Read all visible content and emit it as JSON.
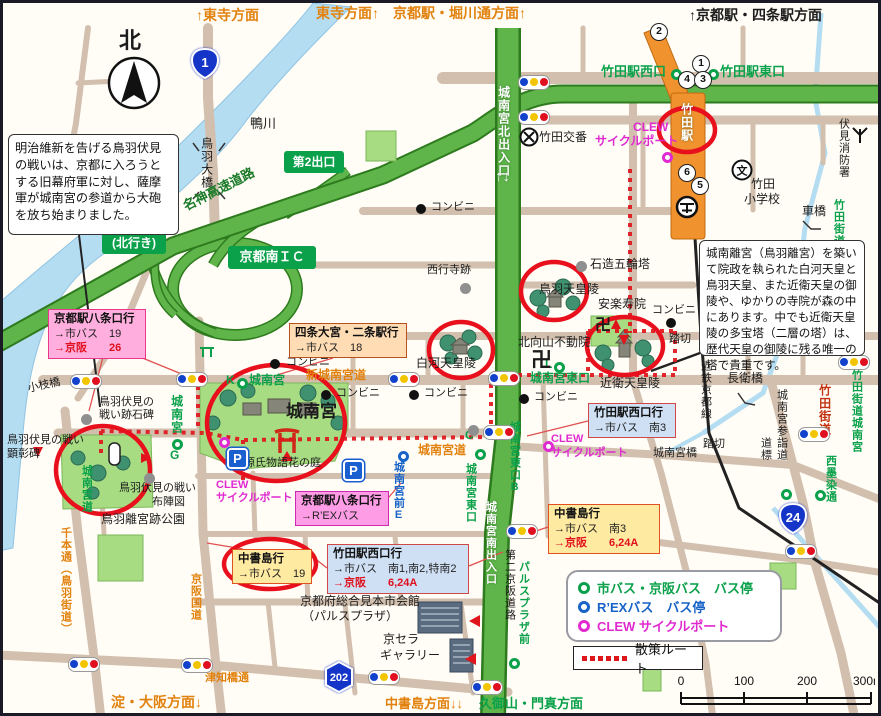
{
  "title": "城南宮・竹田駅周辺 散策マップ",
  "edge_labels": [
    {
      "t": "↑東寺方面",
      "x": 193,
      "y": 5,
      "c": "orange",
      "s": 14
    },
    {
      "t": "東寺方面↑　京都駅・堀川通方面↑",
      "x": 313,
      "y": 3,
      "c": "orange",
      "s": 14
    },
    {
      "t": "↑京都駅・四条駅方面",
      "x": 686,
      "y": 5,
      "c": "dark",
      "s": 14,
      "b": 1
    },
    {
      "t": "淀・大阪方面↓",
      "x": 108,
      "y": 692,
      "c": "orange",
      "s": 14
    },
    {
      "t": "中書島方面↓↓",
      "x": 382,
      "y": 694,
      "c": "orange",
      "s": 13
    },
    {
      "t": "久御山・門真方面",
      "x": 476,
      "y": 694,
      "c": "green",
      "s": 13
    }
  ],
  "labels": [
    {
      "t": "北",
      "x": 116,
      "y": 26,
      "c": "dark",
      "s": 22,
      "b": 1
    },
    {
      "t": "鴨川",
      "x": 247,
      "y": 114,
      "c": "dark",
      "s": 13
    },
    {
      "t": "鳥羽大橋",
      "x": 197,
      "y": 134,
      "c": "dark",
      "s": 12,
      "v": 1
    },
    {
      "t": "名神高速道路",
      "x": 178,
      "y": 198,
      "c": "hwy",
      "s": 13,
      "r": -27
    },
    {
      "t": "小枝橋",
      "x": 24,
      "y": 381,
      "c": "dark",
      "s": 11,
      "r": -12
    },
    {
      "t": "竹田交番",
      "x": 536,
      "y": 128,
      "c": "dark",
      "s": 12
    },
    {
      "t": "竹田",
      "x": 748,
      "y": 175,
      "c": "dark",
      "s": 12
    },
    {
      "t": "小学校",
      "x": 741,
      "y": 190,
      "c": "dark",
      "s": 12
    },
    {
      "t": "伏見消防署",
      "x": 834,
      "y": 115,
      "c": "dark",
      "s": 11,
      "v": 1
    },
    {
      "t": "車橋",
      "x": 799,
      "y": 202,
      "c": "dark",
      "s": 12
    },
    {
      "t": "西行寺跡",
      "x": 424,
      "y": 262,
      "c": "dark",
      "s": 11
    },
    {
      "t": "石造五輪塔",
      "x": 587,
      "y": 255,
      "c": "dark",
      "s": 12
    },
    {
      "t": "鳥羽天皇陵",
      "x": 536,
      "y": 280,
      "c": "dark",
      "s": 12
    },
    {
      "t": "安楽寿院",
      "x": 595,
      "y": 295,
      "c": "dark",
      "s": 12
    },
    {
      "t": "北向山不動院",
      "x": 515,
      "y": 333,
      "c": "dark",
      "s": 12
    },
    {
      "t": "白河天皇陵",
      "x": 413,
      "y": 354,
      "c": "dark",
      "s": 12
    },
    {
      "t": "近衛天皇陵",
      "x": 597,
      "y": 374,
      "c": "dark",
      "s": 12
    },
    {
      "t": "踏切",
      "x": 666,
      "y": 331,
      "c": "dark",
      "s": 11
    },
    {
      "t": "踏切",
      "x": 700,
      "y": 436,
      "c": "dark",
      "s": 11
    },
    {
      "t": "長衛橋",
      "x": 724,
      "y": 369,
      "c": "dark",
      "s": 12
    },
    {
      "t": "近鉄京都線",
      "x": 696,
      "y": 357,
      "c": "dark",
      "s": 11,
      "v": 1
    },
    {
      "t": "城南宮参詣道",
      "x": 772,
      "y": 386,
      "c": "dark",
      "s": 11,
      "v": 1
    },
    {
      "t": "道標",
      "x": 756,
      "y": 434,
      "c": "dark",
      "s": 11,
      "v": 1
    },
    {
      "t": "城南宮橋",
      "x": 650,
      "y": 445,
      "c": "dark",
      "s": 11
    },
    {
      "t": "城南宮",
      "x": 283,
      "y": 400,
      "c": "dark",
      "s": 17,
      "b": 1
    },
    {
      "t": "源氏物語花の庭",
      "x": 241,
      "y": 455,
      "c": "dark",
      "s": 11
    },
    {
      "t": "鳥羽伏見の",
      "x": 96,
      "y": 394,
      "c": "dark",
      "s": 11
    },
    {
      "t": "戦い跡石碑",
      "x": 96,
      "y": 407,
      "c": "dark",
      "s": 11
    },
    {
      "t": "鳥羽伏見の戦い",
      "x": 4,
      "y": 432,
      "c": "dark",
      "s": 11
    },
    {
      "t": "顕彰碑",
      "x": 4,
      "y": 446,
      "c": "dark",
      "s": 11
    },
    {
      "t": "鳥羽伏見の戦い",
      "x": 116,
      "y": 480,
      "c": "dark",
      "s": 11
    },
    {
      "t": "布陣図",
      "x": 149,
      "y": 494,
      "c": "dark",
      "s": 11
    },
    {
      "t": "鳥羽離宮跡公園",
      "x": 98,
      "y": 510,
      "c": "dark",
      "s": 12
    },
    {
      "t": "京都府総合見本市会館",
      "x": 297,
      "y": 592,
      "c": "dark",
      "s": 12
    },
    {
      "t": "（パルスプラザ）",
      "x": 299,
      "y": 607,
      "c": "dark",
      "s": 12
    },
    {
      "t": "京セラ",
      "x": 380,
      "y": 630,
      "c": "dark",
      "s": 12
    },
    {
      "t": "ギャラリー",
      "x": 377,
      "y": 646,
      "c": "dark",
      "s": 12
    },
    {
      "t": "津知橋通",
      "x": 202,
      "y": 670,
      "c": "orange",
      "s": 11
    },
    {
      "t": "第二京阪道路",
      "x": 500,
      "y": 546,
      "c": "dark",
      "s": 11,
      "v": 1
    },
    {
      "t": "新城南宮道",
      "x": 303,
      "y": 366,
      "c": "orange",
      "s": 12
    },
    {
      "t": "城南宮道",
      "x": 415,
      "y": 441,
      "c": "orange",
      "s": 12
    },
    {
      "t": "千本通（鳥羽街道）",
      "x": 56,
      "y": 524,
      "c": "orange",
      "s": 11,
      "v": 1
    },
    {
      "t": "京阪国道",
      "x": 186,
      "y": 570,
      "c": "orange",
      "s": 11,
      "v": 1
    },
    {
      "t": "竹田駅西口",
      "x": 598,
      "y": 62,
      "c": "green",
      "s": 13
    },
    {
      "t": "竹田駅東口",
      "x": 717,
      "y": 62,
      "c": "green",
      "s": 13
    },
    {
      "t": "K",
      "x": 223,
      "y": 371,
      "c": "green",
      "s": 12
    },
    {
      "t": "城南宮",
      "x": 246,
      "y": 371,
      "c": "green",
      "s": 12
    },
    {
      "t": "城南宮",
      "x": 167,
      "y": 392,
      "c": "green",
      "s": 12,
      "v": 1
    },
    {
      "t": "G",
      "x": 167,
      "y": 446,
      "c": "green",
      "s": 12
    },
    {
      "t": "L",
      "x": 542,
      "y": 355,
      "c": "green",
      "s": 12
    },
    {
      "t": "城南宮東口",
      "x": 527,
      "y": 369,
      "c": "green",
      "s": 12
    },
    {
      "t": "城南宮東口B",
      "x": 505,
      "y": 418,
      "c": "green",
      "s": 11,
      "v": 1
    },
    {
      "t": "C",
      "x": 462,
      "y": 426,
      "c": "green",
      "s": 12
    },
    {
      "t": "城南宮東口",
      "x": 461,
      "y": 460,
      "c": "green",
      "s": 11,
      "v": 1
    },
    {
      "t": "城南宮道",
      "x": 77,
      "y": 462,
      "c": "green",
      "s": 11,
      "v": 1
    },
    {
      "t": "パルスプラザ前",
      "x": 514,
      "y": 558,
      "c": "green",
      "s": 11,
      "v": 1
    },
    {
      "t": "竹田街道",
      "x": 829,
      "y": 196,
      "c": "green",
      "s": 11,
      "v": 1
    },
    {
      "t": "竹田街道城南宮",
      "x": 847,
      "y": 366,
      "c": "green",
      "s": 11,
      "v": 1
    },
    {
      "t": "西墨染通",
      "x": 821,
      "y": 452,
      "c": "green",
      "s": 11,
      "v": 1
    },
    {
      "t": "城南宮前E",
      "x": 389,
      "y": 458,
      "c": "blue",
      "s": 11,
      "v": 1
    },
    {
      "t": "CLEW",
      "x": 630,
      "y": 118,
      "c": "mag",
      "s": 12
    },
    {
      "t": "サイクルポート",
      "x": 592,
      "y": 132,
      "c": "mag",
      "s": 12
    },
    {
      "t": "CLEW",
      "x": 213,
      "y": 477,
      "c": "mag",
      "s": 11
    },
    {
      "t": "サイクルポート",
      "x": 213,
      "y": 490,
      "c": "mag",
      "s": 11
    },
    {
      "t": "CLEW",
      "x": 548,
      "y": 431,
      "c": "mag",
      "s": 11
    },
    {
      "t": "サイクルポート",
      "x": 548,
      "y": 445,
      "c": "mag",
      "s": 11
    },
    {
      "t": "竹田街道",
      "x": 815,
      "y": 381,
      "c": "redst",
      "s": 12,
      "v": 1
    },
    {
      "t": "城南宮北出入口",
      "x": 494,
      "y": 83,
      "c": "white",
      "s": 12,
      "v": 1
    },
    {
      "t": "↑↓",
      "x": 492,
      "y": 166,
      "c": "white",
      "s": 15
    },
    {
      "t": "城南宮南出入口",
      "x": 481,
      "y": 498,
      "c": "white",
      "s": 11,
      "v": 1
    },
    {
      "t": "竹田駅",
      "x": 677,
      "y": 100,
      "c": "white",
      "s": 12,
      "v": 1
    },
    {
      "t": "コンビニ",
      "x": 283,
      "y": 354,
      "c": "dark",
      "s": 11
    },
    {
      "t": "コンビニ",
      "x": 333,
      "y": 385,
      "c": "dark",
      "s": 11
    },
    {
      "t": "コンビニ",
      "x": 421,
      "y": 385,
      "c": "dark",
      "s": 11
    },
    {
      "t": "コンビニ",
      "x": 531,
      "y": 389,
      "c": "dark",
      "s": 11
    },
    {
      "t": "コンビニ",
      "x": 649,
      "y": 302,
      "c": "dark",
      "s": 11
    },
    {
      "t": "コンビニ",
      "x": 428,
      "y": 199,
      "c": "dark",
      "s": 11
    },
    {
      "t": "卍",
      "x": 592,
      "y": 315,
      "c": "dark",
      "s": 16,
      "b": 1
    },
    {
      "t": "卍",
      "x": 528,
      "y": 347,
      "c": "dark",
      "s": 21,
      "b": 1
    }
  ],
  "green_boxes": [
    {
      "lines": [
        "第2出口"
      ],
      "x": 281,
      "y": 148,
      "w": 60,
      "h": 22,
      "s": 12
    },
    {
      "lines": [
        "第1出口",
        "(北行き)"
      ],
      "x": 99,
      "y": 214,
      "w": 64,
      "h": 37,
      "s": 12
    },
    {
      "lines": [
        "京都南ＩＣ"
      ],
      "x": 225,
      "y": 243,
      "w": 88,
      "h": 23,
      "s": 13
    }
  ],
  "info_boxes": [
    {
      "text": "明治維新を告げる鳥羽伏見の戦いは、京都に入ろうとする旧幕府軍に対し、薩摩軍が城南宮の参道から大砲を放ち始まりました。",
      "x": 5,
      "y": 131,
      "w": 171,
      "h": 101,
      "s": 12.2
    },
    {
      "text": "城南離宮（鳥羽離宮）を築いて院政を執られた白河天皇と鳥羽天皇、また近衛天皇の御陵や、ゆかりの寺院が森の中にあります。中でも近衛天皇陵の多宝塔（二層の塔）は、歴代天皇の御陵に残る唯一の塔で貴重です。",
      "x": 696,
      "y": 237,
      "w": 166,
      "h": 116,
      "s": 11.6
    }
  ],
  "bus_boxes": [
    {
      "title": "京都駅八条口行",
      "rows": [
        {
          "t": "→市バス　19",
          "red": false
        },
        {
          "t": "→京阪　　26",
          "red": true
        }
      ],
      "x": 45,
      "y": 306,
      "w": 98,
      "h": 48,
      "bg": "#ffaede",
      "bd": "#e8388c"
    },
    {
      "title": "四条大宮・二条駅行",
      "rows": [
        {
          "t": "→市バス　18",
          "red": false
        }
      ],
      "x": 286,
      "y": 320,
      "w": 118,
      "h": 35,
      "bg": "#ffdcb4",
      "bd": "#b85020"
    },
    {
      "title": "竹田駅西口行",
      "rows": [
        {
          "t": "→市バス　南3",
          "red": false
        }
      ],
      "x": 585,
      "y": 400,
      "w": 88,
      "h": 35,
      "bg": "#cfe0f5",
      "bd": "#d04848"
    },
    {
      "title": "中書島行",
      "rows": [
        {
          "t": "→市バス　南3",
          "red": false
        },
        {
          "t": "→京阪　　6,24A",
          "red": true
        }
      ],
      "x": 545,
      "y": 501,
      "w": 112,
      "h": 48,
      "bg": "#ffeaa2",
      "bd": "#e05020"
    },
    {
      "title": "中書島行",
      "rows": [
        {
          "t": "→市バス　19",
          "red": false
        }
      ],
      "x": 229,
      "y": 546,
      "w": 80,
      "h": 35,
      "bg": "#ffeaa2",
      "bd": "#e05020"
    },
    {
      "title": "竹田駅西口行",
      "rows": [
        {
          "t": "→市バス　南1,南2,特南2",
          "red": false
        },
        {
          "t": "→京阪　　6,24A",
          "red": true
        }
      ],
      "x": 324,
      "y": 541,
      "w": 142,
      "h": 48,
      "bg": "#cfe0f5",
      "bd": "#d04848"
    },
    {
      "title": "京都駅八条口行",
      "rows": [
        {
          "t": "→R’EXバス",
          "red": false
        }
      ],
      "x": 292,
      "y": 488,
      "w": 94,
      "h": 34,
      "bg": "#ff9ce6",
      "bd": "#cc28b0"
    }
  ],
  "legend": {
    "items": [
      {
        "label": "市バス・京阪バス　バス停",
        "color": "#0aa14a"
      },
      {
        "label": "R’EXバス　バス停",
        "color": "#1763c8"
      },
      {
        "label": "CLEW サイクルポート",
        "color": "#e02ad0"
      }
    ],
    "route_label": "散策ルート"
  },
  "scale": {
    "ticks": [
      "0",
      "100",
      "200",
      "300m"
    ]
  },
  "compass_label": "北",
  "shields": [
    {
      "t": "1",
      "x": 202,
      "y": 60,
      "shape": "onigiri"
    },
    {
      "t": "24",
      "x": 790,
      "y": 515,
      "shape": "onigiri"
    },
    {
      "t": "202",
      "x": 336,
      "y": 674,
      "shape": "hex"
    }
  ],
  "circled_numbers": [
    {
      "n": "2",
      "x": 655,
      "y": 28
    },
    {
      "n": "1",
      "x": 697,
      "y": 60
    },
    {
      "n": "4",
      "x": 683,
      "y": 76
    },
    {
      "n": "3",
      "x": 699,
      "y": 76
    },
    {
      "n": "6",
      "x": 683,
      "y": 169
    },
    {
      "n": "5",
      "x": 696,
      "y": 182
    }
  ],
  "markers": {
    "traffic_lights": [
      [
        530,
        78
      ],
      [
        530,
        113
      ],
      [
        82,
        377
      ],
      [
        188,
        375
      ],
      [
        400,
        375
      ],
      [
        500,
        374
      ],
      [
        495,
        428
      ],
      [
        518,
        527
      ],
      [
        850,
        358
      ],
      [
        810,
        430
      ],
      [
        797,
        547
      ],
      [
        80,
        660
      ],
      [
        193,
        661
      ],
      [
        380,
        673
      ],
      [
        483,
        683
      ]
    ],
    "bus_stops_green": [
      [
        673,
        71
      ],
      [
        710,
        71
      ],
      [
        239,
        380
      ],
      [
        174,
        441
      ],
      [
        477,
        451
      ],
      [
        556,
        364
      ],
      [
        783,
        491
      ],
      [
        817,
        492
      ],
      [
        511,
        660
      ]
    ],
    "bus_stops_blue": [
      [
        400,
        453
      ]
    ],
    "cycle_ports": [
      [
        664,
        154
      ],
      [
        221,
        439
      ],
      [
        545,
        443
      ]
    ],
    "convenience_dots": [
      [
        272,
        361
      ],
      [
        323,
        392
      ],
      [
        411,
        392
      ],
      [
        521,
        396
      ],
      [
        668,
        320
      ],
      [
        418,
        206
      ]
    ],
    "gray_dots": [
      [
        83,
        416
      ],
      [
        146,
        475
      ],
      [
        470,
        427
      ],
      [
        578,
        263
      ],
      [
        462,
        285
      ]
    ],
    "parking": [
      [
        232,
        453
      ],
      [
        348,
        465
      ]
    ]
  },
  "colors": {
    "road": "#d2bfae",
    "highway": "#5fb54a",
    "river": "#b5ddf2",
    "route_red": "#e0151c",
    "station_orange": "#f0922e",
    "bus_green": "#0aa14a",
    "rex_blue": "#1763c8",
    "clew_magenta": "#e02ad0",
    "signal_blue": "#1242cc",
    "signal_yellow": "#f2c500",
    "signal_red": "#e01020",
    "shield_blue": "#1535c8"
  }
}
